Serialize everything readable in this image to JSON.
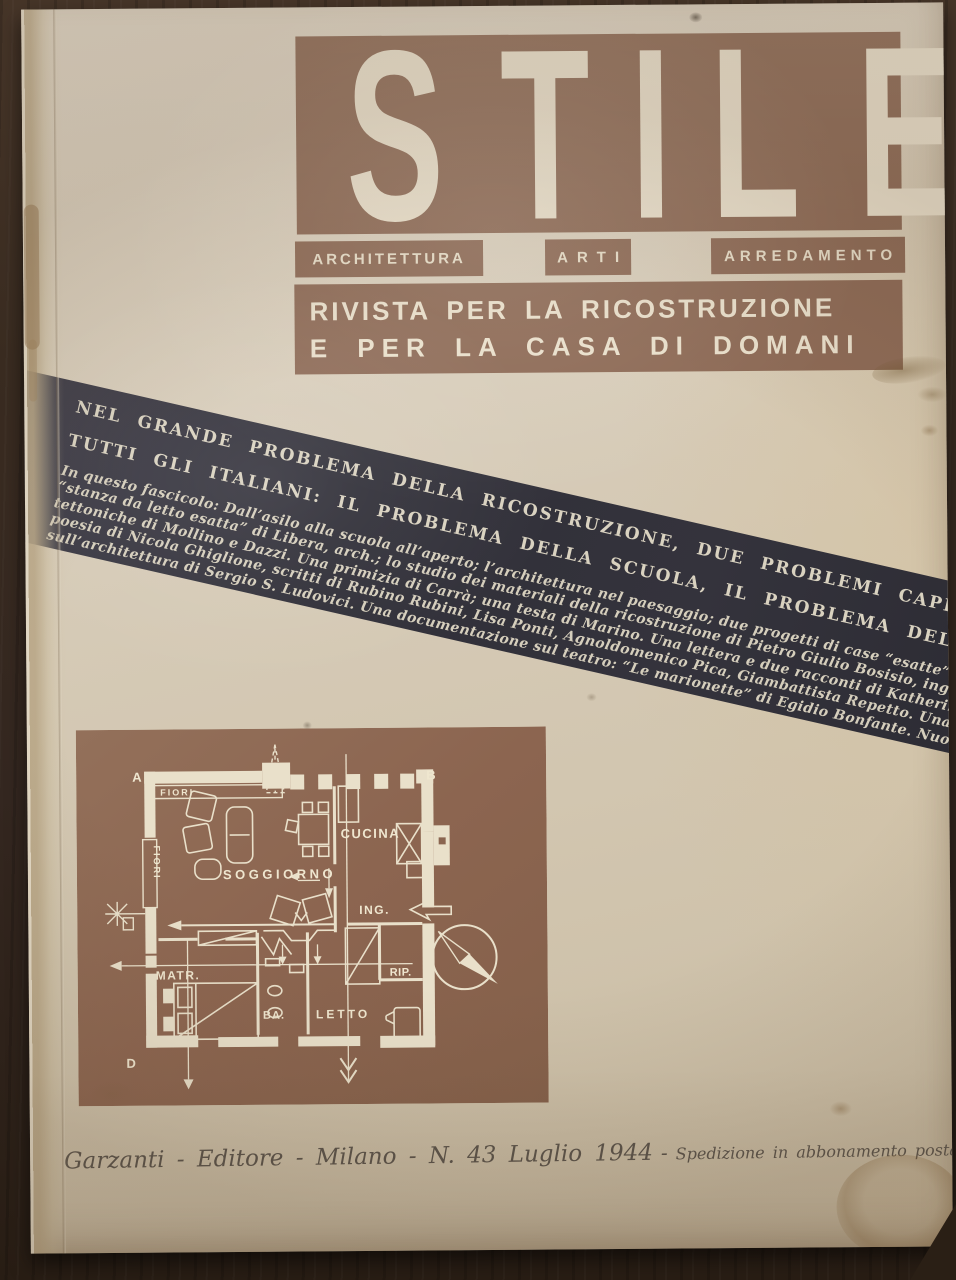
{
  "cover": {
    "masthead": {
      "letters": [
        "S",
        "T",
        "I",
        "L",
        "E"
      ],
      "categories": [
        "ARCHITETTURA",
        "ARTI",
        "ARREDAMENTO"
      ],
      "subtitle_line1": "RIVISTA PER LA RICOSTRUZIONE",
      "subtitle_line2": "E PER LA CASA DI DOMANI"
    },
    "banner": {
      "headline_line1": "NEL GRANDE PROBLEMA DELLA RICOSTRUZIONE, DUE PROBLEMI CAPITALI PER",
      "headline_line2": "TUTTI GLI ITALIANI: IL PROBLEMA DELLA SCUOLA, IL PROBLEMA DEL PAESAGGIO",
      "summary_lines": [
        "In questo fascicolo: Dall’asilo alla scuola all’aperto; l’architettura nel paesaggio; due progetti di case “esatte” di Gio Ponti; la",
        "“stanza da letto esatta” di Libera, arch.; lo studio dei materiali della ricostruzione di Pietro Giulio Bosisio, ing. Primizie archi-",
        "tettoniche di Mollino e Dazzi. Una primizia di Carrà; una testa di Marino. Una lettera e due racconti di Katherine Mansfield; una",
        "poesia di Nicola Ghiglione, scritti di Rubino Rubini, Lisa Ponti, Agnoldomenico Pica, Giambattista Repetto. Una grande discussione",
        "sull’architettura di Sergio S. Ludovici. Una documentazione sul teatro: “Le marionette” di Egidio Bonfante. Nuovi disegni di mobili."
      ]
    },
    "floor_plan": {
      "corner_a": "A",
      "corner_b": "B",
      "corner_d": "D",
      "planter_top": "FIORI",
      "planter_side": "FIORI",
      "living": "SOGGIORNO",
      "kitchen": "CUCINA",
      "entry": "ING.",
      "master": "MATR.",
      "bath": "BA.",
      "bed": "LETTO",
      "storage": "RIP."
    },
    "imprint": {
      "publisher": "Garzanti - Editore - Milano - N. 43 Luglio 1944",
      "dash": "-",
      "postal": "Spedizione in abbonamento postale - Gruppo III Milano"
    },
    "colors": {
      "masthead_brown": "#8d6a56",
      "plan_brown": "#8c6550",
      "banner_black": "#32313a",
      "paper_cream": "#d6cbb8",
      "ink_white": "#e6ddc9",
      "script_ink": "#57514a"
    }
  }
}
